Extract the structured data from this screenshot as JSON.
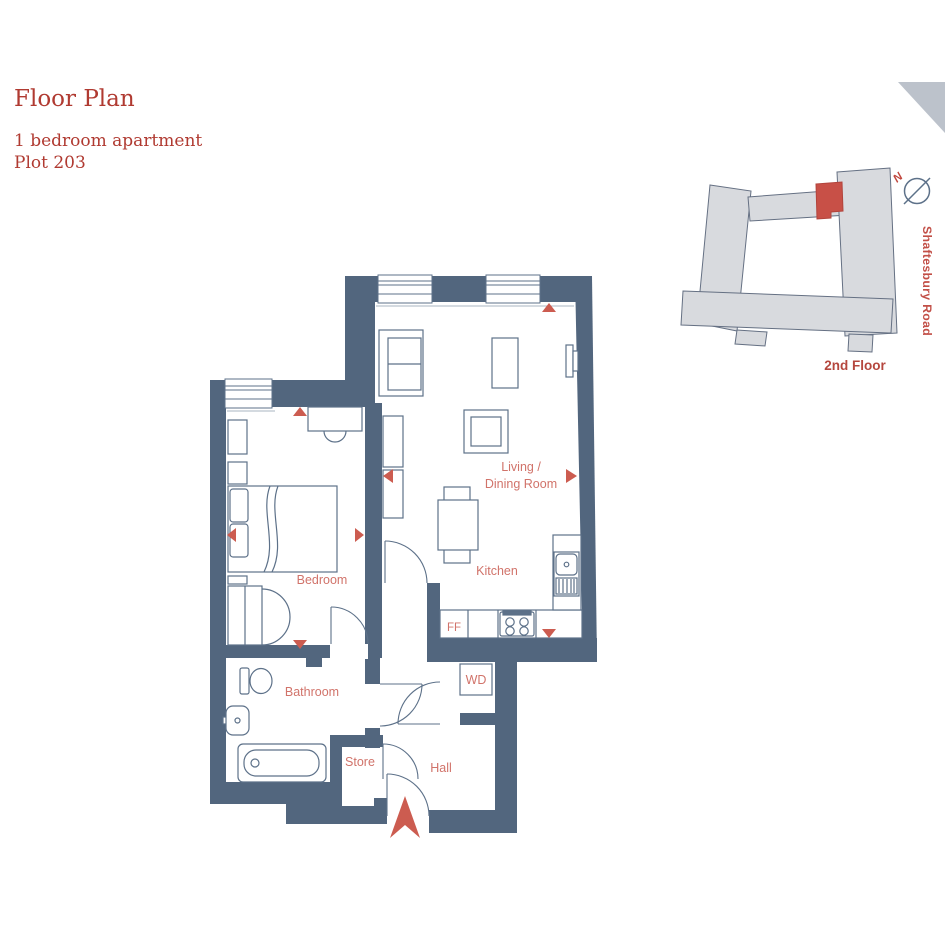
{
  "header": {
    "title": "Floor Plan",
    "subtitle1": "1 bedroom apartment",
    "subtitle2": "Plot 203"
  },
  "plan": {
    "living_line1": "Living /",
    "living_line2": "Dining Room",
    "kitchen": "Kitchen",
    "bedroom": "Bedroom",
    "bathroom": "Bathroom",
    "store": "Store",
    "hall": "Hall",
    "ff": "FF",
    "wd": "WD"
  },
  "map": {
    "north": "N",
    "road": "Shaftesbury Road",
    "floor": "2nd Floor"
  },
  "colors": {
    "wall": "#52667e",
    "furniture_line": "#5d7189",
    "room_label": "#d1736a",
    "title_red": "#b03a31",
    "marker_red": "#cc5c50",
    "map_building_fill": "#d8dade",
    "map_unit_red": "#c85047",
    "corner_triangle": "#bcc2cb"
  }
}
